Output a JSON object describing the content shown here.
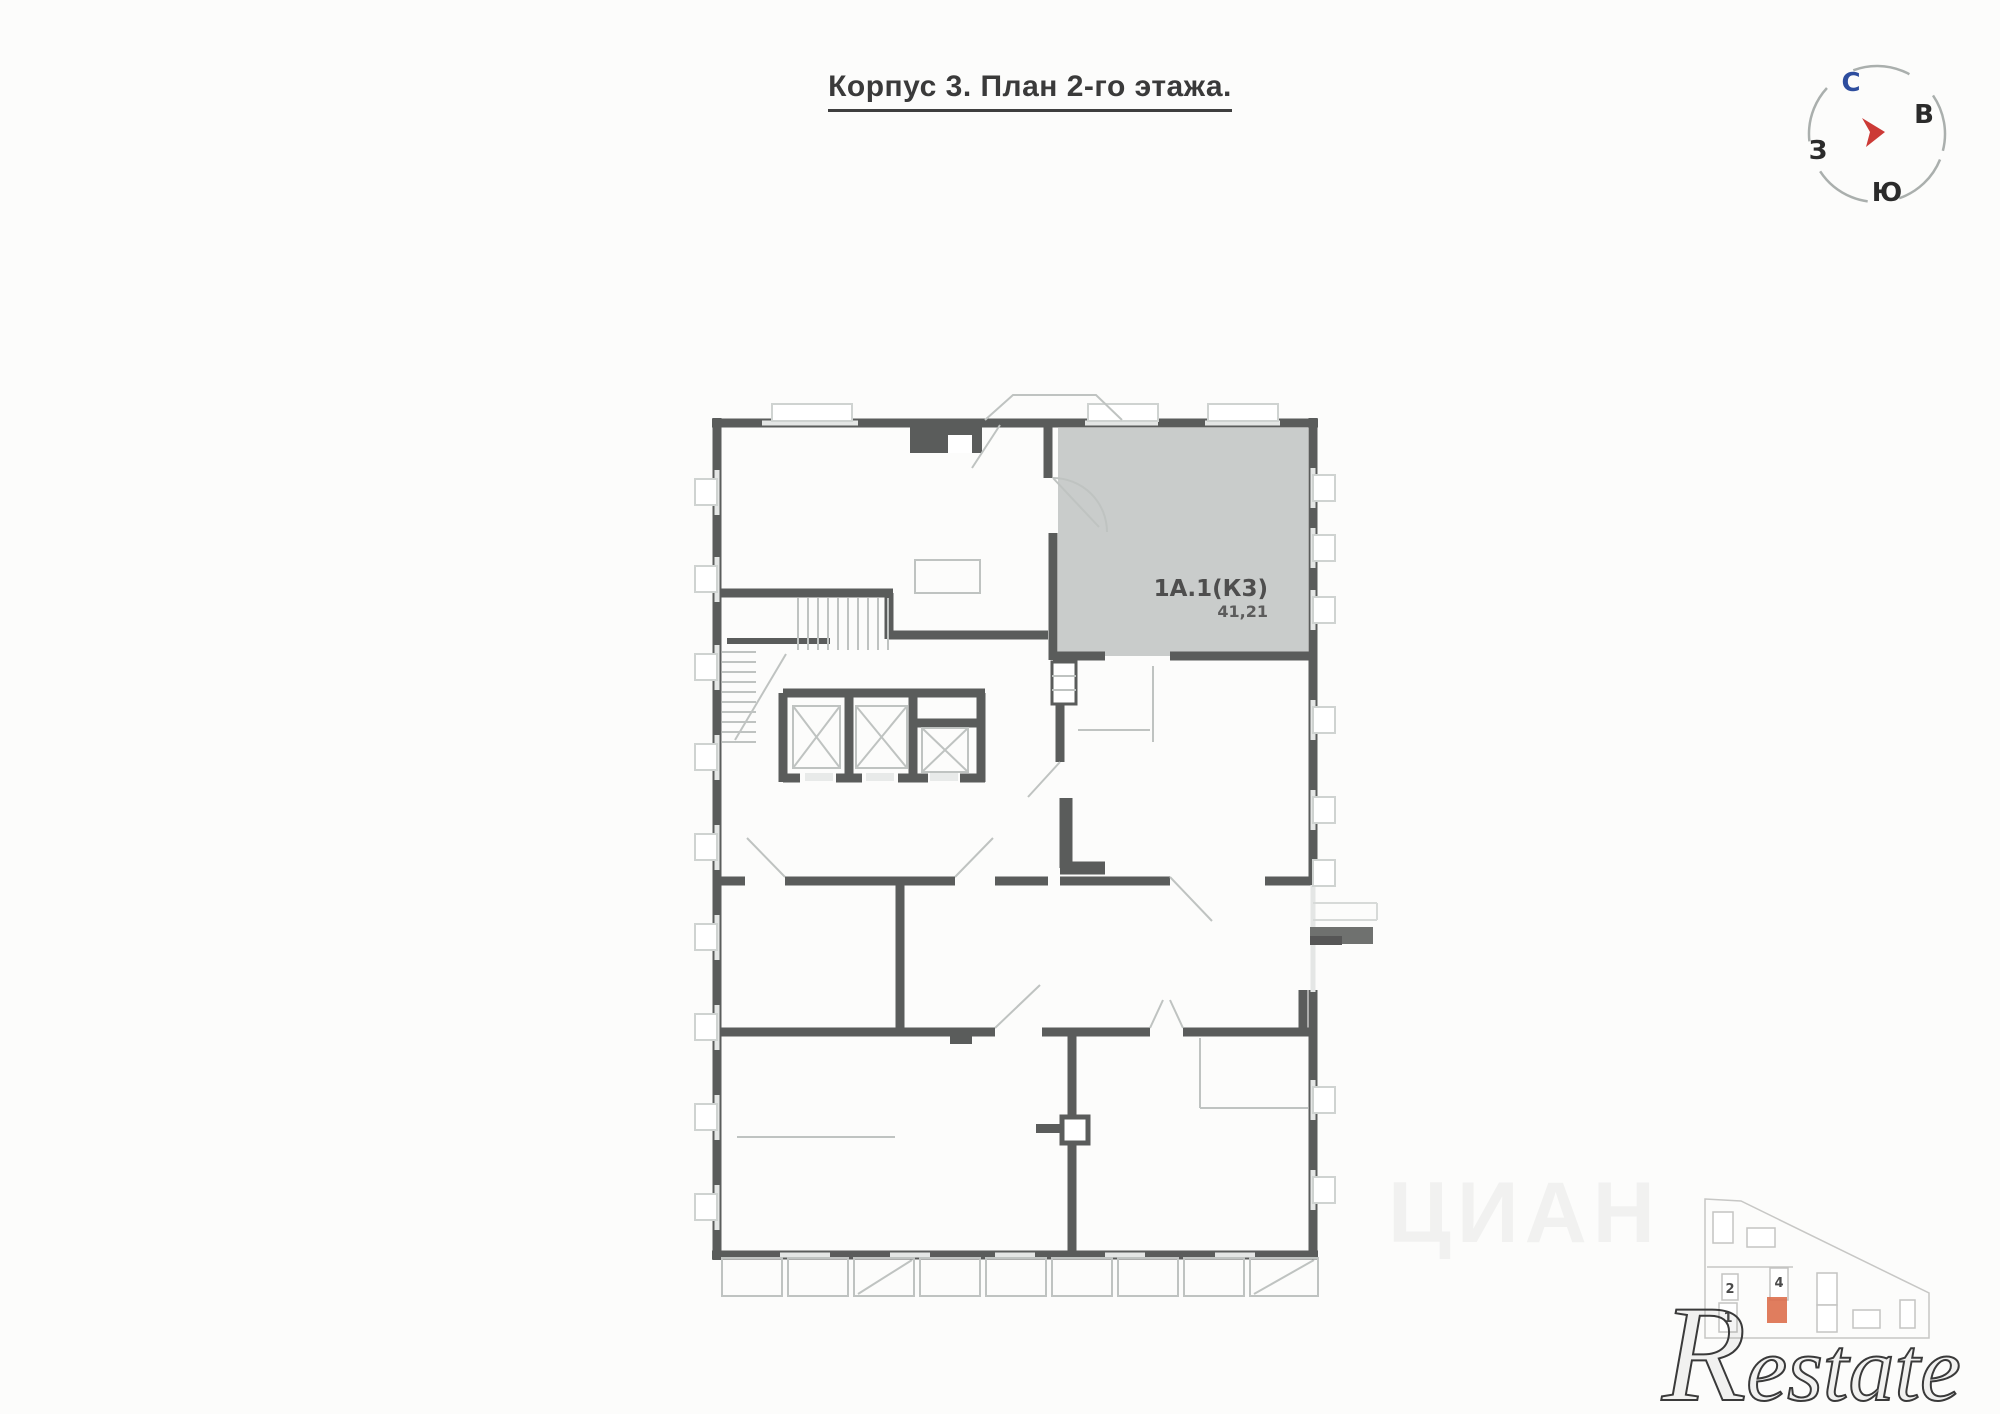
{
  "title": {
    "text": "Корпус 3. План 2-го этажа."
  },
  "compass": {
    "north": "С",
    "east": "В",
    "south": "Ю",
    "west": "З",
    "north_color": "#2d4d9e",
    "letter_color": "#2b2b2b",
    "arrow_color": "#cc3a36"
  },
  "floor_plan": {
    "highlighted_unit": {
      "id": "1А.1(К3)",
      "area": "41,21",
      "fill_color": "#c9cccb"
    },
    "wall_color": "#5a5c5b"
  },
  "site_plan": {
    "building_labels": {
      "b2": "2",
      "b4": "4",
      "b1": "1"
    },
    "highlight_color": "#dd6f4c"
  },
  "watermarks": {
    "brand": "Restate",
    "portal": "ЦИАН"
  }
}
